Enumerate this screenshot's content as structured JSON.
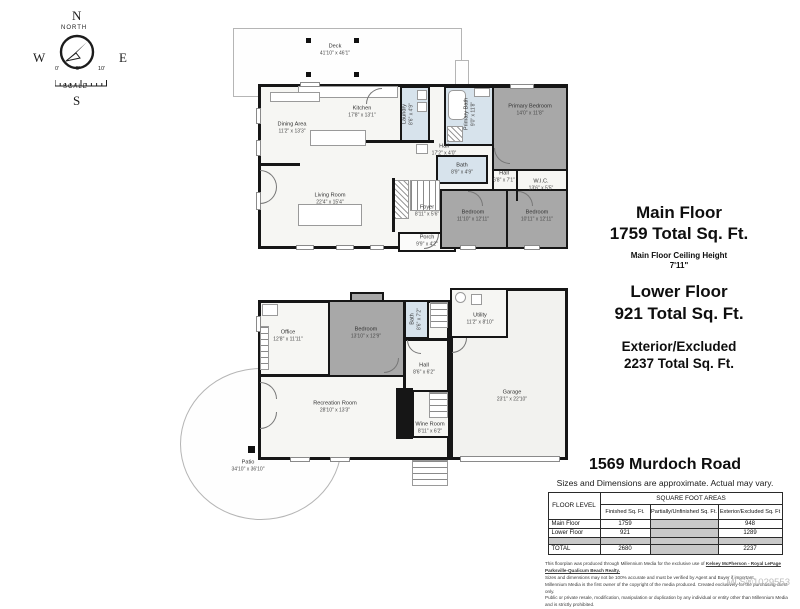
{
  "compass": {
    "n": "N",
    "e": "E",
    "s": "S",
    "w": "W",
    "north": "NORTH",
    "scale": "SCALE",
    "ticks": [
      "0'",
      "5'",
      "10'"
    ]
  },
  "main_floor": {
    "rooms": [
      {
        "name": "Deck",
        "dims": "41'10\" x 46'1\""
      },
      {
        "name": "Dining Area",
        "dims": "11'2\" x 13'3\""
      },
      {
        "name": "Kitchen",
        "dims": "17'8\" x 13'1\""
      },
      {
        "name": "Laundry",
        "dims": "8'6\" x 4'9\""
      },
      {
        "name": "Primary Bath",
        "dims": "9'0\" x 11'8\""
      },
      {
        "name": "Primary Bedroom",
        "dims": "14'0\" x 11'8\""
      },
      {
        "name": "W.I.C.",
        "dims": "13'6\" x 5'5\""
      },
      {
        "name": "Hall",
        "dims": "17'2\" x 4'0\""
      },
      {
        "name": "Hall",
        "dims": "6'8\" x 7'1\""
      },
      {
        "name": "Bath",
        "dims": "8'9\" x 4'9\""
      },
      {
        "name": "Living Room",
        "dims": "22'4\" x 15'4\""
      },
      {
        "name": "Foyer",
        "dims": "8'11\" x 5'6\""
      },
      {
        "name": "Porch",
        "dims": "9'9\" x 4'2\""
      },
      {
        "name": "Bedroom",
        "dims": "11'10\" x 12'11\""
      },
      {
        "name": "Bedroom",
        "dims": "10'11\" x 12'11\""
      }
    ]
  },
  "lower_floor": {
    "rooms": [
      {
        "name": "Office",
        "dims": "12'8\" x 11'11\""
      },
      {
        "name": "Bedroom",
        "dims": "13'10\" x 12'9\""
      },
      {
        "name": "Bath",
        "dims": "8'6\" x 7'2\""
      },
      {
        "name": "Utility",
        "dims": "11'2\" x 8'10\""
      },
      {
        "name": "Hall",
        "dims": "8'6\" x 6'2\""
      },
      {
        "name": "Wine Room",
        "dims": "8'11\" x 6'2\""
      },
      {
        "name": "Recreation Room",
        "dims": "28'10\" x 13'3\""
      },
      {
        "name": "Garage",
        "dims": "23'1\" x 22'10\""
      },
      {
        "name": "Patio",
        "dims": "34'10\" x 36'10\""
      }
    ]
  },
  "summary": {
    "main_title": "Main Floor",
    "main_sqft": "1759 Total Sq. Ft.",
    "ceiling_label": "Main Floor Ceiling Height",
    "ceiling_value": "7'11\"",
    "lower_title": "Lower Floor",
    "lower_sqft": "921 Total Sq. Ft.",
    "ext_title": "Exterior/Excluded",
    "ext_sqft": "2237 Total Sq. Ft."
  },
  "address": "1569 Murdoch Road",
  "disclaimer": "Sizes and Dimensions are approximate. Actual may vary.",
  "table": {
    "floor_level": "FLOOR LEVEL",
    "areas": "SQUARE FOOT AREAS",
    "cols": [
      "Finished Sq. Ft.",
      "Partially/Unfinished Sq. Ft.",
      "Exterior/Excluded Sq. Ft"
    ],
    "rows": [
      {
        "label": "Main Floor",
        "finished": "1759",
        "exterior": "948"
      },
      {
        "label": "Lower Floor",
        "finished": "921",
        "exterior": "1289"
      }
    ],
    "total": {
      "label": "TOTAL",
      "finished": "2680",
      "exterior": "2237"
    }
  },
  "fine_print": {
    "l1a": "This floorplan was produced through Millennium Media for the exclusive use of ",
    "l1b": "Kelsey McPherson - Royal LePage Parksville-Qualicum Beach Realty.",
    "l2": "Sizes and dimensions may not be 100% accurate and must be verified by Agent and Buyer if important.",
    "l3": "Millennium Media is the first owner of the copyright of the media produced. Created exclusively for the purchasing client only.",
    "l4": "Public or private resale, modification, manipulation or duplication by any individual or entity other than Millennium Media and is strictly prohibited."
  },
  "watermark": "MLS®1029553"
}
